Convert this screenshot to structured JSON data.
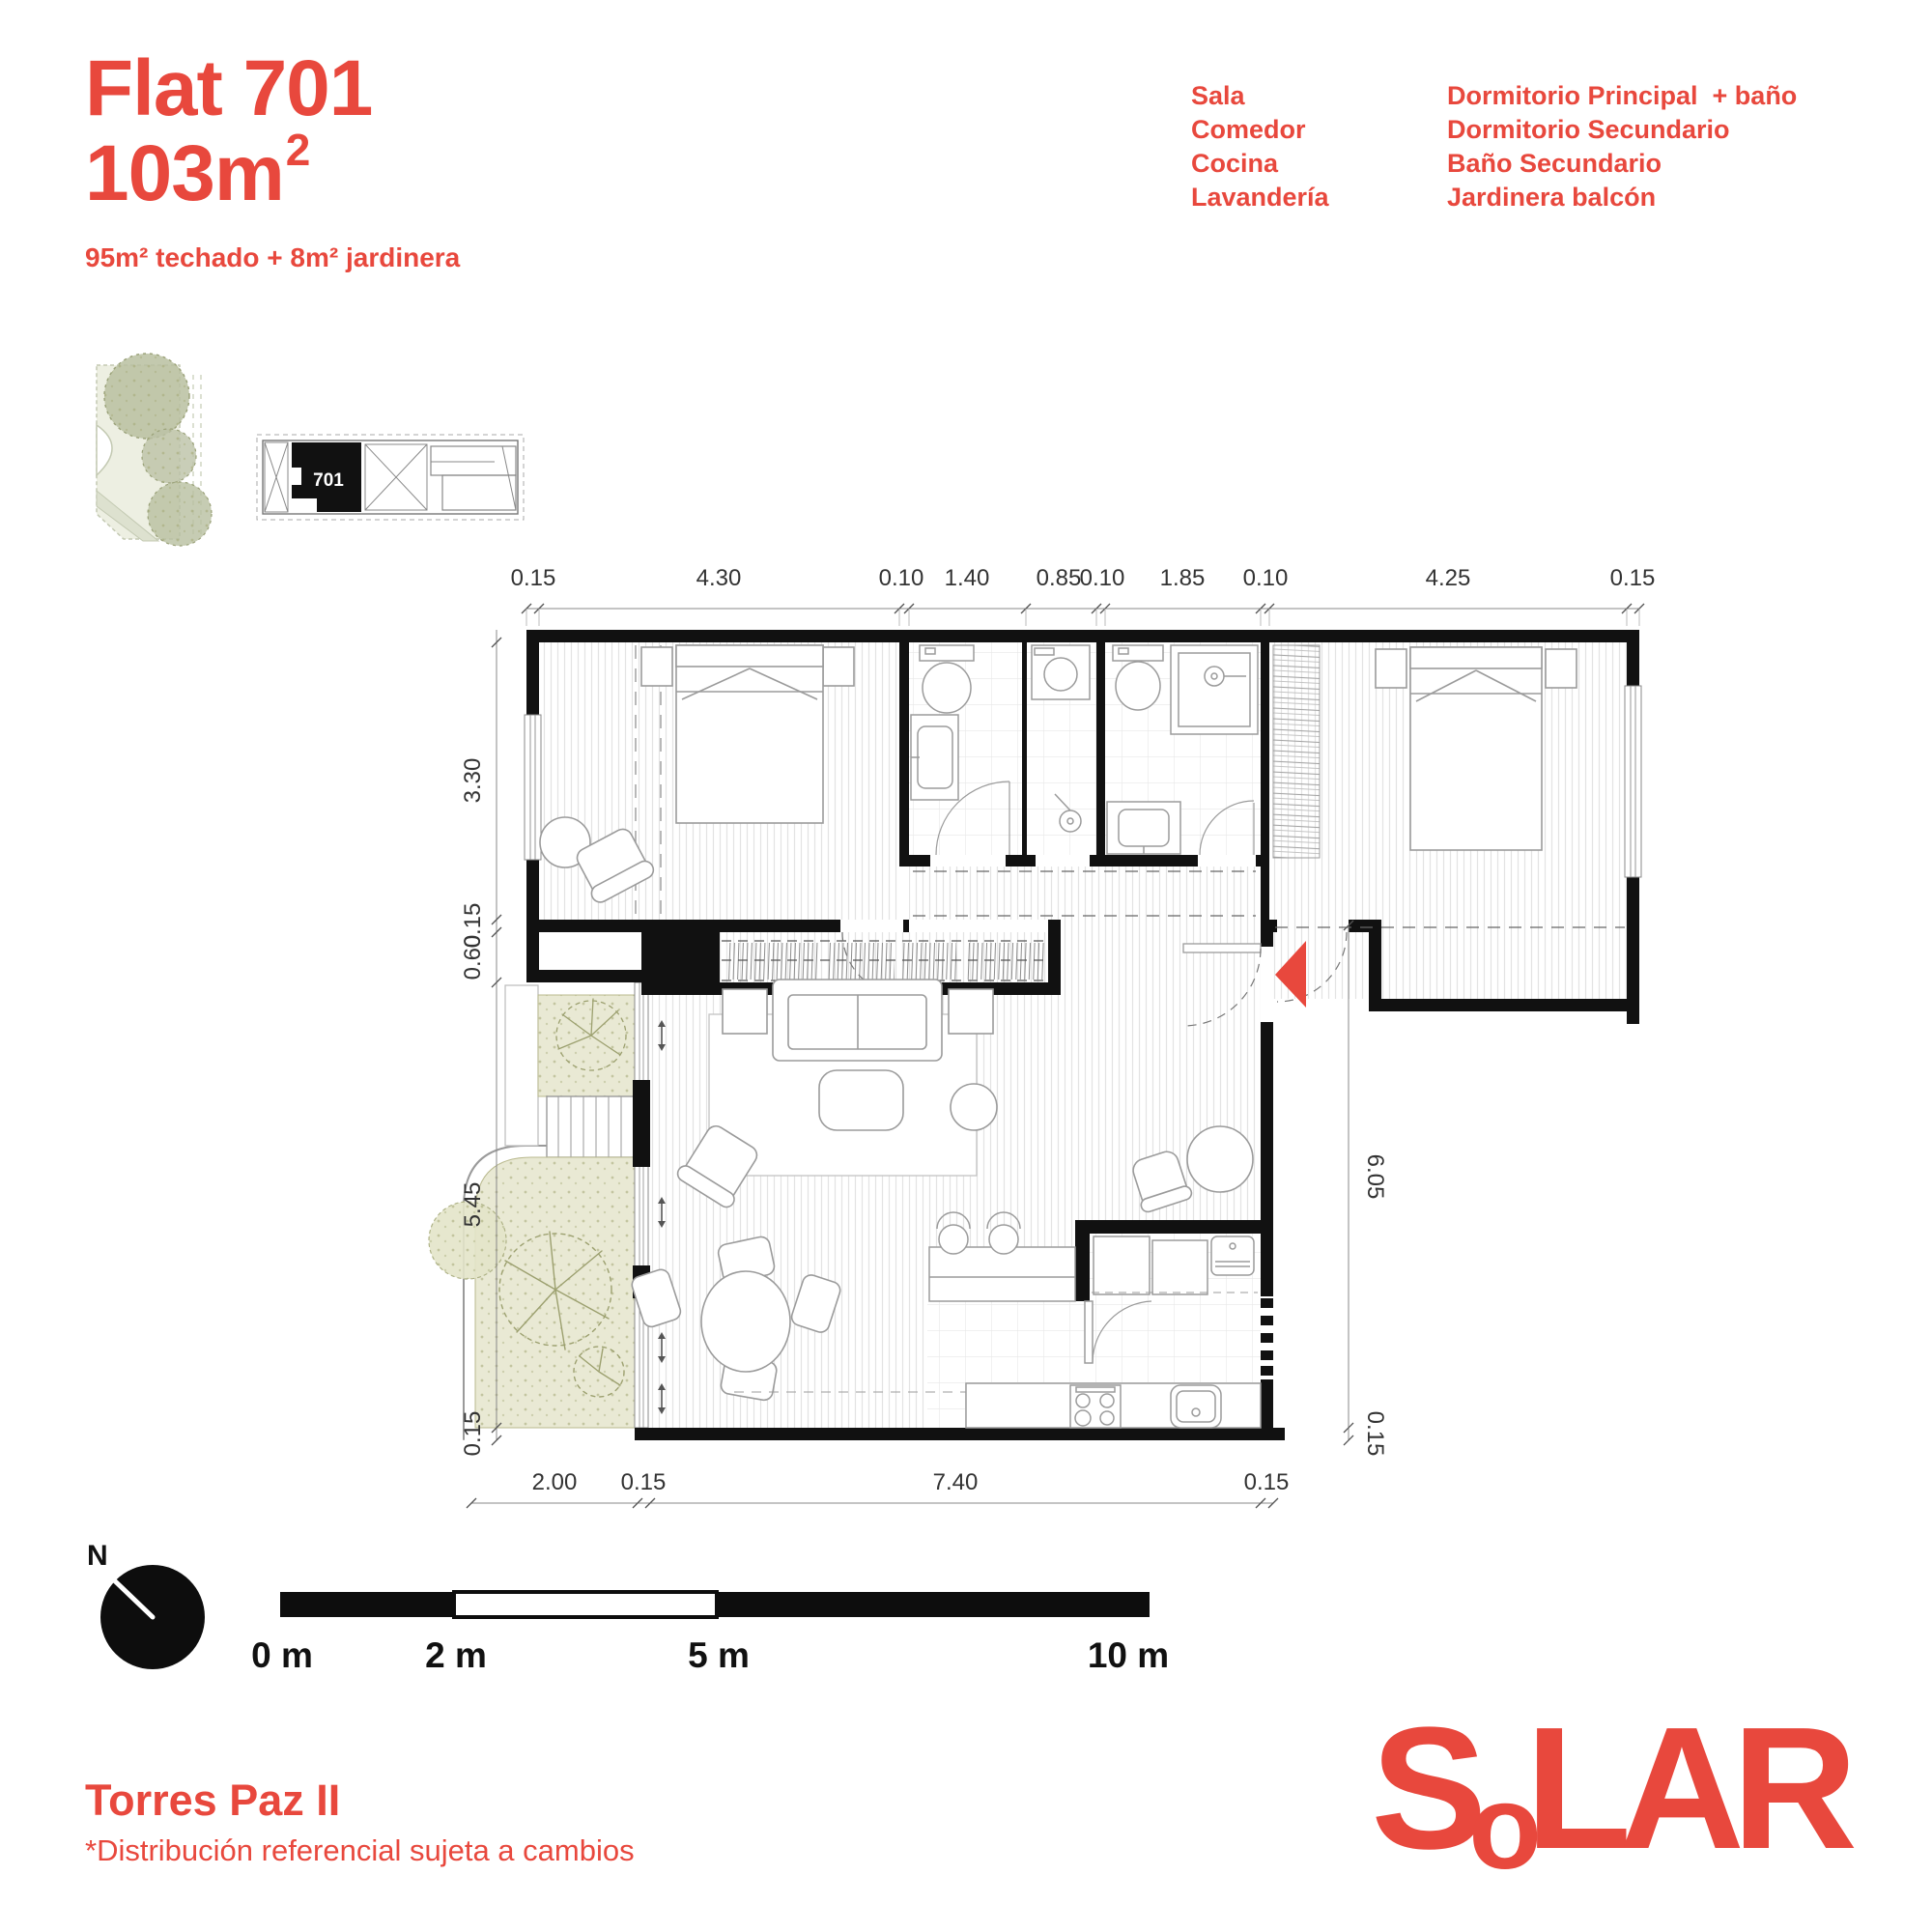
{
  "header": {
    "title": "Flat 701",
    "area_base": "103m",
    "area_sup": "2",
    "subtitle": "95m²  techado + 8m² jardinera"
  },
  "legend": {
    "col1": [
      "Sala",
      "Comedor",
      "Cocina",
      "Lavandería"
    ],
    "col2": [
      "Dormitorio Principal  + baño",
      "Dormitorio Secundario",
      "Baño Secundario",
      "Jardinera balcón"
    ]
  },
  "plan": {
    "unit_number": "701",
    "dims_top": [
      "0.15",
      "4.30",
      "0.10",
      "1.40",
      "0.85",
      "0.10",
      "1.85",
      "0.10",
      "4.25",
      "0.15"
    ],
    "dims_left": [
      "3.30",
      "0.15",
      "0.60",
      "5.45",
      "0.15"
    ],
    "dims_bottom": [
      "2.00",
      "0.15",
      "7.40",
      "0.15"
    ],
    "dims_right": [
      "6.05",
      "0.15"
    ]
  },
  "scalebar": {
    "labels": [
      "0 m",
      "2 m",
      "5 m",
      "10 m"
    ]
  },
  "north_label": "N",
  "footer": {
    "project": "Torres Paz II",
    "disclaimer": "*Distribución referencial sujeta a cambios"
  },
  "logo": {
    "text": "SoLAR",
    "letters": [
      "S",
      "o",
      "L",
      "A",
      "R"
    ]
  },
  "colors": {
    "accent": "#E8483D",
    "planter_green": "#e9e9d4",
    "wall_black": "#111111"
  }
}
